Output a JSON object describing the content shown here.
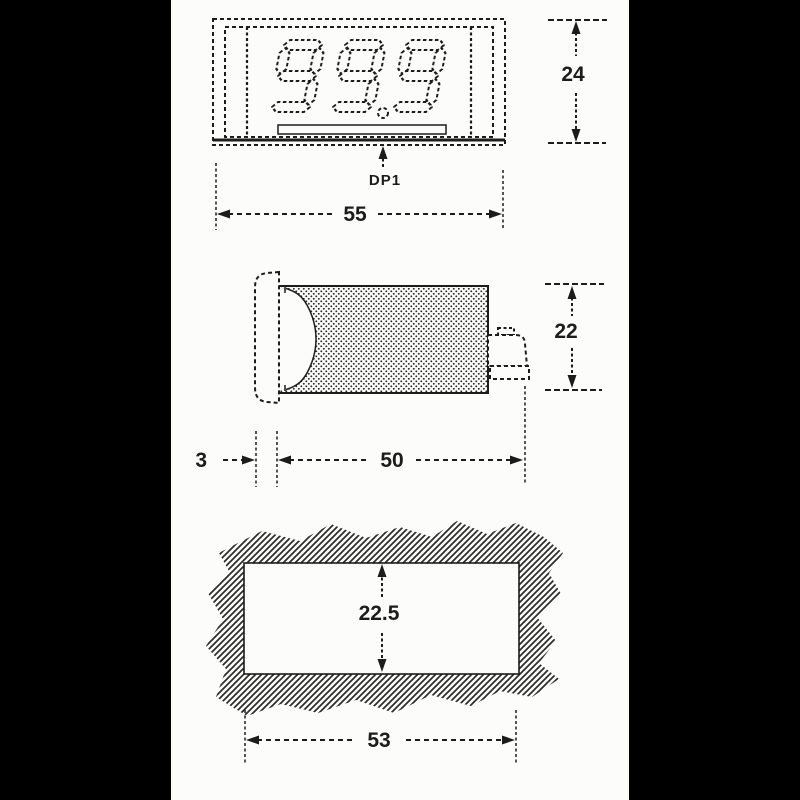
{
  "colors": {
    "paper": "#fcfcfa",
    "ink": "#1c1c1c",
    "border_bars": "#000000"
  },
  "front_view": {
    "display_value": "99.9",
    "decimal_point_label": "DP1",
    "width_dim": "55",
    "height_dim": "24"
  },
  "side_view": {
    "bezel_thickness_dim": "3",
    "body_depth_dim": "50",
    "height_dim": "22"
  },
  "panel_cutout": {
    "height_dim": "22.5",
    "width_dim": "53"
  }
}
